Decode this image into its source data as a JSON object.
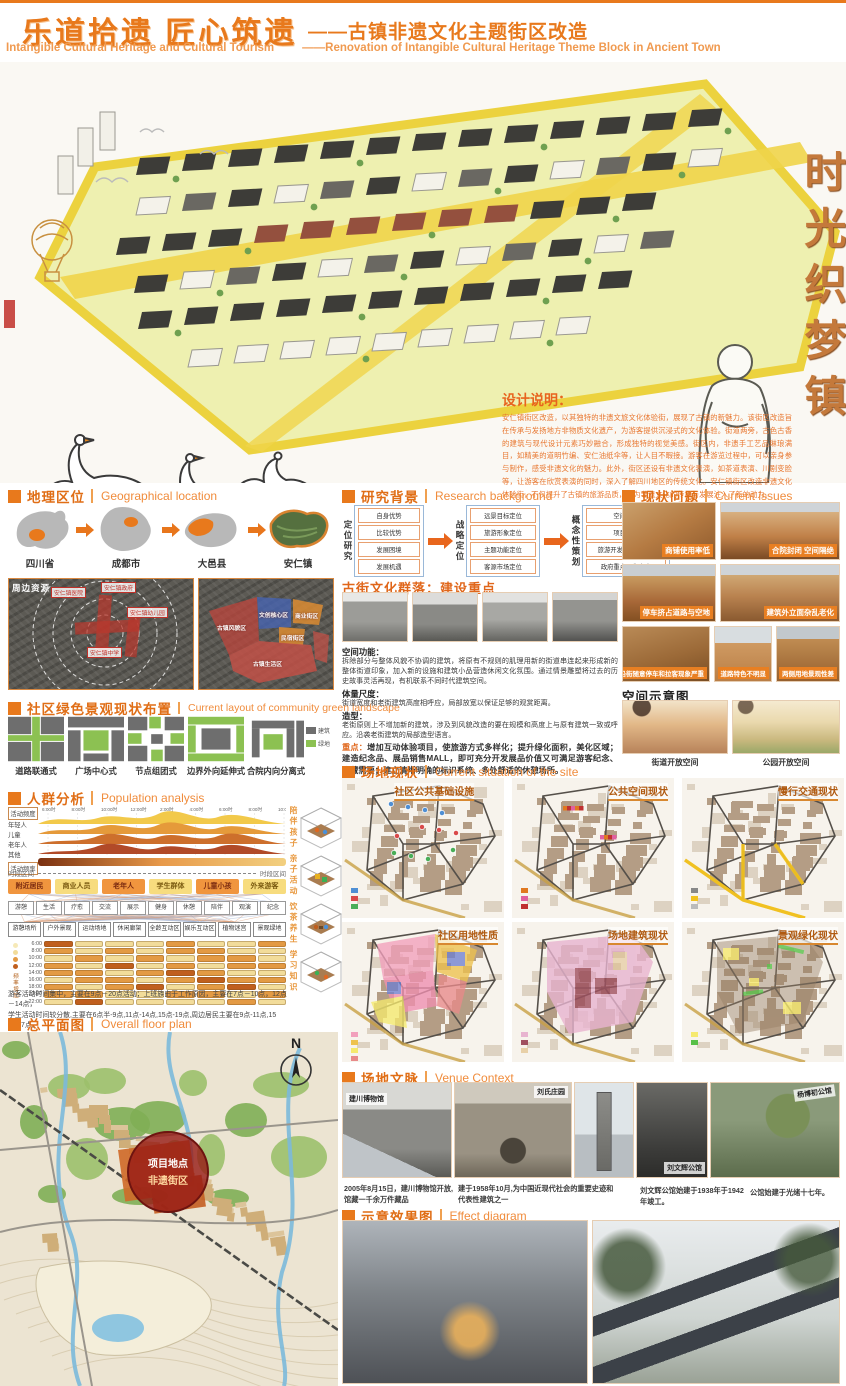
{
  "header": {
    "title_cn": "乐道拾遗 匠心筑遗",
    "subtitle_cn": "——古镇非遗文化主题街区改造",
    "title_en": "Intangible Cultural Heritage and Cultural Tourism",
    "subtitle_en": "——Renovation of Intangible Cultural Heritage Theme Block in Ancient Town"
  },
  "hero": {
    "calligraphy": "时光织梦镇",
    "design_title": "设计说明：",
    "design_text": "安仁镇街区改造，以其独特的非遗文旅文化体验街，展现了古镇的新魅力。该街区改造旨在传承与发扬地方非物质文化遗产，为游客提供沉浸式的文化体验。街道两旁，古色古香的建筑与现代设计元素巧妙融合，形成独特的视觉美感。街区内，非遗手工艺品琳琅满目，如精美的道明竹编、安仁油纸伞等，让人目不暇接。游客在游览过程中，可以亲身参与制作，感受非遗文化的魅力。此外，街区还设有非遗文化表演，如茶道表演、川剧变脸等，让游客在欣赏表演的同时，深入了解四川地区的传统文化。安仁镇街区改造非遗文化体验街，不仅提升了古镇的旅游品质，也为非遗文化的传承与发展注入了新的动力。"
  },
  "geo": {
    "title_cn": "地理区位",
    "title_en": "Geographical location",
    "steps": [
      "四川省",
      "成都市",
      "大邑县",
      "安仁镇"
    ],
    "sat_left_tag": "周边资源",
    "sat_left_labels": [
      "安仁镇医院",
      "安仁镇政府",
      "安仁镇幼儿园",
      "安仁镇中学"
    ],
    "sat_right_labels": [
      "古镇风貌区",
      "文创核心区",
      "商业街区",
      "民宿街区",
      "古镇生活区"
    ]
  },
  "research": {
    "title_cn": "研究背景",
    "title_en": "Research background",
    "col1_title": "定位研究",
    "col1_items": [
      "自身优势",
      "比较优势",
      "发展困境",
      "发展机遇"
    ],
    "col2_title": "战略定位",
    "col2_items": [
      "远景目标定位",
      "旅游形象定位",
      "主题功能定位",
      "客源市场定位"
    ],
    "col3_title": "概念性策划",
    "col3_items": [
      "空间布局",
      "项目架构",
      "旅游开发起步区建设",
      "政府重点工作内容"
    ]
  },
  "street": {
    "title": "古街文化群落：建设重点",
    "p1_label": "空间功能：",
    "p1": "拆除部分与整体风貌不协调的建筑，将原有不规则的肌理用新的街道串连起来形成新的整体街道印象，加入新的设施和建筑小品营造休闲文化氛围。通过情景雕塑将过去的历史故事灵活再现，有机联系不同时代建筑空间。",
    "p2_label": "体量尺度：",
    "p2": "街道宽度和老街建筑高度相呼应，局部放宽以保证足够的观赏距离。",
    "p3_label": "造型：",
    "p3": "老街原则上不增加新的建筑，涉及到风貌改造的要在规模和高度上与原有建筑一致或呼应。沿袭老街建筑的局部造型语言。",
    "p4_label": "重点：",
    "p4": "增加互动体验项目，使旅游方式多样化；提升绿化面积，美化区域；建造纪念品、展品销售MALL，即可充分开发展品价值又可满足游客纪念、收藏需要；建立清晰明确的标识系统、多处舒适的休憩场所。"
  },
  "issues": {
    "title_cn": "现状问题",
    "title_en": "Current issues",
    "captions": [
      "商铺使用率低",
      "合院封闭 空间隔绝",
      "停车挤占道路与空地",
      "建筑外立面杂乱老化",
      "沿街随意停车和拉客现象严重",
      "道路特色不明显",
      "两侧用地景观性差"
    ]
  },
  "space": {
    "title": "空间示意图",
    "captions": [
      "街道开放空间",
      "公园开放空间"
    ]
  },
  "green": {
    "title_cn": "社区绿色景观现状布置",
    "title_en": "Current layout of community green landscape",
    "types": [
      "道路联通式",
      "广场中心式",
      "节点组团式",
      "边界外向延伸式",
      "合院内向分离式"
    ],
    "legend": [
      "建筑",
      "绿地"
    ]
  },
  "population": {
    "title_cn": "人群分析",
    "title_en": "Population analysis",
    "time_ticks": [
      "6:00时",
      "8:00时",
      "10:00时",
      "12:00时",
      "2:00时",
      "4:00时",
      "6:00时",
      "8:00时",
      "10:00时"
    ],
    "freq_top": "活动频度",
    "freq_bottom": "活动频率",
    "ridge_rows": [
      "年轻人",
      "儿童",
      "老年人",
      "其他"
    ],
    "interval_label": "时段区间",
    "groups": [
      "附近居民",
      "商业人员",
      "老年人",
      "学生群体",
      "儿童小孩",
      "外来游客"
    ],
    "activities": [
      "游憩",
      "生活",
      "疗愈",
      "交流",
      "展示",
      "健身",
      "休憩",
      "陪伴",
      "观演",
      "纪念"
    ],
    "venues": [
      "游憩场所",
      "户外景观",
      "运动场地",
      "休闲廊架",
      "全龄互动区",
      "娱乐互动区",
      "植物迷宫",
      "景观绿地"
    ],
    "gantt_times": [
      "6:00",
      "8:00",
      "10:00",
      "12:00",
      "14:00",
      "16:00",
      "18:00",
      "20:00",
      "22:00"
    ],
    "gantt_axis": "频率增加",
    "gantt_rows": [
      [
        3,
        1,
        1,
        1,
        2,
        1,
        1,
        2
      ],
      [
        2,
        1,
        2,
        1,
        2,
        2,
        1,
        1
      ],
      [
        1,
        2,
        1,
        2,
        1,
        2,
        2,
        1
      ],
      [
        2,
        1,
        3,
        1,
        2,
        1,
        2,
        2
      ],
      [
        2,
        2,
        1,
        2,
        3,
        2,
        1,
        1
      ],
      [
        1,
        2,
        2,
        1,
        2,
        3,
        2,
        2
      ],
      [
        2,
        1,
        2,
        3,
        1,
        2,
        3,
        1
      ],
      [
        2,
        2,
        1,
        1,
        2,
        2,
        1,
        2
      ],
      [
        1,
        3,
        1,
        1,
        1,
        1,
        2,
        1
      ]
    ],
    "side_labels": [
      "陪伴孩子",
      "亲子活动",
      "饮茶养生",
      "学习知识"
    ],
    "caption1": "游客活动时间集中，主要在9点－20点活动；上班族由于工作原因，主要在7点－10点，12点－14点，",
    "caption2": "学生活动时间较分散,主要在6点半-9点,11点-14点,15点-19点,周边居民主要在9点-11点,15点-17点。"
  },
  "site": {
    "title_cn": "场地现状",
    "title_en": "Current situation of the site",
    "maps": [
      "社区公共基础设施",
      "公共空间现状",
      "慢行交通现状",
      "社区用地性质",
      "场地建筑现状",
      "景观绿化现状"
    ]
  },
  "plan": {
    "title_cn": "总平面图",
    "title_en": "Overall floor plan",
    "north": "N",
    "marker1": "项目地点",
    "marker2": "非遗街区"
  },
  "venue": {
    "title_cn": "场地文脉",
    "title_en": "Venue Context",
    "photos": [
      {
        "label": "建川博物馆",
        "caption": "2005年8月15日，建川博物馆开放,馆藏一千余万件藏品"
      },
      {
        "label": "刘氏庄园",
        "caption": "建于1958年10月,为中国近现代社会的重要史迹和代表性建筑之一"
      },
      {
        "label": "",
        "caption": ""
      },
      {
        "label": "刘文辉公馆",
        "caption": "刘文辉公馆始建于1938年于1942年竣工。"
      },
      {
        "label": "杨博初公馆",
        "caption": "公馆始建于光绪十七年。"
      }
    ]
  },
  "effect": {
    "title_cn": "示意效果图",
    "title_en": "Effect diagram"
  }
}
